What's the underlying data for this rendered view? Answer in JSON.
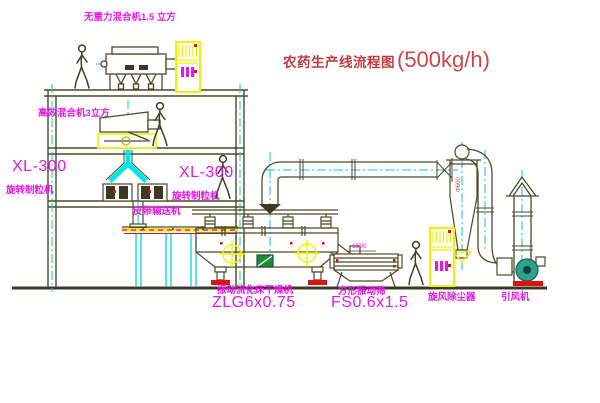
{
  "title": {
    "text": "农药生产线流程图",
    "capacity": "(500kg/h)"
  },
  "labels": {
    "mixer_top": "无重力混合机1.5 立方",
    "mixer_floor2": "高效混合机3立方",
    "granulator_model_left": "XL-300",
    "granulator_name_left": "旋转制粒机",
    "granulator_model_right": "XL-300",
    "granulator_name_right": "旋转制粒机",
    "belt_conveyor": "皮带输送机",
    "dryer_name": "振动流化床干燥机",
    "dryer_model": "ZLG6x0.75",
    "sieve_name": "方形振动筛",
    "sieve_model": "FS0.6x1.5",
    "cyclone": "旋风除尘器",
    "fan": "引风机"
  },
  "dimensions": {
    "cyclone_diameter": "Φ600",
    "sieve_length": "1500"
  },
  "colors": {
    "label_magenta": "#e816e8",
    "title_red": "#c23b3b",
    "line_olive": "#4a4a28",
    "centerline_cyan": "#00cccc",
    "highlight_yellow": "#f2f200",
    "accent_red": "#e01010",
    "logo_green": "#1f8a3a",
    "fan_teal": "#2fa08c"
  }
}
